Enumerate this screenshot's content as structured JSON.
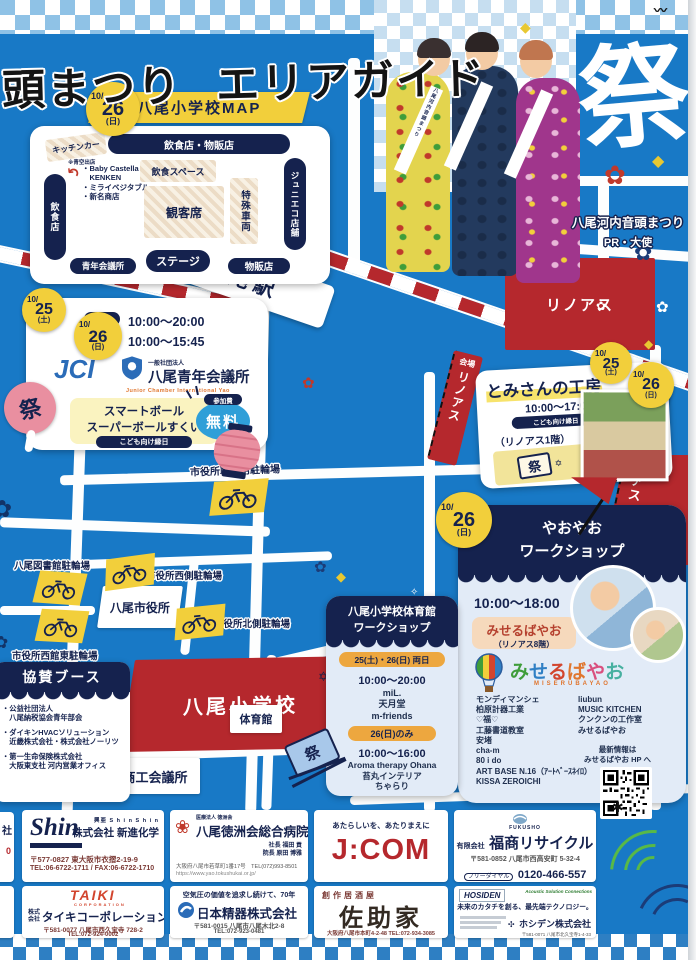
{
  "title": {
    "part1": "頭まつり",
    "part2": "エリアガイド"
  },
  "badges": {
    "mo": "10/",
    "d25": "25",
    "d26": "26",
    "sat": "(土)",
    "sun": "(日)"
  },
  "matsuri_char": "祭",
  "pr": {
    "caption1": "八尾河内音頭まつり",
    "caption2": "PR・大使"
  },
  "station": "近鉄八尾駅",
  "linoas": "リノアス",
  "flag": {
    "venue": "会場",
    "name": "リノアス"
  },
  "school_map": {
    "title": "八尾小学校MAP",
    "kitchen_car": "キッチンカー",
    "kitchen_note": "※青空出店",
    "food_goods": "飲食店・物販店",
    "vendor1": "・Baby Castella",
    "vendor1b": "　KENKEN",
    "vendor2": "・ミライベジタブル",
    "vendor3": "・新名商店",
    "food_space": "飲食スペース",
    "audience": "観客席",
    "special_vehicle": "特殊車両",
    "junieco": "ジュニエコ店舗",
    "restaurant": "飲食店",
    "jc_room": "青年会議所",
    "stage": "ステージ",
    "goods": "物販店"
  },
  "jci": {
    "d25": "25日",
    "t25": "10:00～20:00",
    "d26": "26日",
    "t26": "10:00～15:45",
    "logo": "JCI",
    "org_pre": "一般社団法人",
    "org": "八尾青年会議所",
    "eng": "Junior Chamber International Yao",
    "event1": "スマートボール",
    "event2": "スーパーボールすくい",
    "kids": "こども向け縁日",
    "fee_label": "参加費",
    "fee": "無料"
  },
  "tomisan": {
    "title": "とみさんの工房",
    "time": "10:00～17:00",
    "kids": "こども向け縁日",
    "floor": "（リノアス1階）"
  },
  "yaoyao": {
    "t1": "やおやお",
    "t2": "ワークショップ",
    "time": "10:00～18:00",
    "venue": "みせるばやお",
    "floor": "（リノアス8階）",
    "logo": "みせるばやお",
    "logo_sub": "MISERUBAYAO",
    "left": [
      "モンディマンシェ",
      "柏原計器工業",
      "♡福♡",
      "工藤書道教室",
      "安堵",
      "cha-m",
      "80 i do",
      "ART BASE N.16（ｱｰﾄﾍﾞｰｽﾈｲﾛ）",
      "KISSA ZEROICHI"
    ],
    "right": [
      "liubun",
      "MUSIC KITCHEN",
      "クンクンの工作室",
      "みせるばやお"
    ],
    "info1": "最新情報は",
    "info2": "みせるばやお HP へ"
  },
  "gym": {
    "t1": "八尾小学校体育館",
    "t2": "ワークショップ",
    "both_badge": "25(土)・26(日) 両日",
    "both_time": "10:00～20:00",
    "both": [
      "miL.",
      "天月堂",
      "m-friends"
    ],
    "sun_badge": "26(日)のみ",
    "sun_time": "10:00～16:00",
    "sun": [
      "Aroma therapy Ohana",
      "苔丸インテリア",
      "ちゃらり"
    ]
  },
  "parking": {
    "staff": "市役所職員用駐輪場",
    "library": "八尾図書館駐輪場",
    "west": "市役所西側駐輪場",
    "north": "市役所北側駐輪場",
    "west_annex": "市役所西館東駐輪場"
  },
  "buildings": {
    "city_hall": "八尾市役所",
    "school": "八尾小学校",
    "gym": "体育館",
    "cci": "商工会議所"
  },
  "booth": {
    "title": "協賛ブース",
    "i1a": "・公益社団法人",
    "i1b": "　八尾納税協会青年部会",
    "i2a": "・ダイキンHVACソリューション",
    "i2b": "　近畿株式会社・株式会社ノーリツ",
    "i3a": "・第一生命保険株式会社",
    "i3b": "　大阪東支社 河内営業オフィス"
  },
  "sponsors": {
    "edge1a": "社",
    "edge1b": "0",
    "shin": {
      "logo": "Shin",
      "tag": "興亜 S h i n S h i n",
      "name": "株式会社 新進化学",
      "addr": "〒577-0827 東大阪市衣摺2-19-9",
      "tel": "TEL:06-6722-1711 / FAX:06-6722-1710"
    },
    "tokushukai": {
      "org": "医療法人 徳洲会",
      "name": "八尾徳洲会総合病院",
      "p1": "社長 福田 貢",
      "p2": "院長 原田 博雅",
      "addr": "大阪府八尾市若草町1番17号　TEL(072)993-8501",
      "url": "https://www.yao.tokushukai.or.jp/"
    },
    "jcom": {
      "tag": "あたらしいを、あたりまえに",
      "name": "J:COM"
    },
    "fukusho": {
      "logo": "FUKUSHO",
      "pre": "有限会社",
      "name": "福商リサイクル",
      "addr": "〒581-0852 八尾市西高安町 5-32-4",
      "tel_label": "フリーダイヤル",
      "tel": "0120-466-557"
    },
    "taiki": {
      "logo": "TAIKI",
      "sub": "CORPORATION",
      "pre": "株式会社",
      "name": "タイキコーポレーション",
      "addr": "〒581-0077 八尾市西久宝寺 728-2",
      "tel": "TEL:072-924-0002"
    },
    "nihonseiki": {
      "tag": "空気圧の価値を追求し続けて、70年",
      "name": "日本精器株式会社",
      "addr": "〒581-0015 八尾市八尾木北2-8",
      "tel": "TEL:072-923-0481"
    },
    "sasukeya": {
      "genre": "創作居酒屋",
      "name": "佐助家",
      "addr": "大阪府八尾市本町4-2-48 TEL:072-934-3085"
    },
    "hosiden": {
      "logo": "HOSIDEN",
      "corner": "Acoustic Solution Connections",
      "tag": "未来のカタチを創る、最先端テクノロジー。",
      "name": "ホシデン株式会社",
      "addr": "〒581-0071 八尾市北久宝寺1-4-33",
      "tel": "TEL:072-993-1010"
    }
  }
}
